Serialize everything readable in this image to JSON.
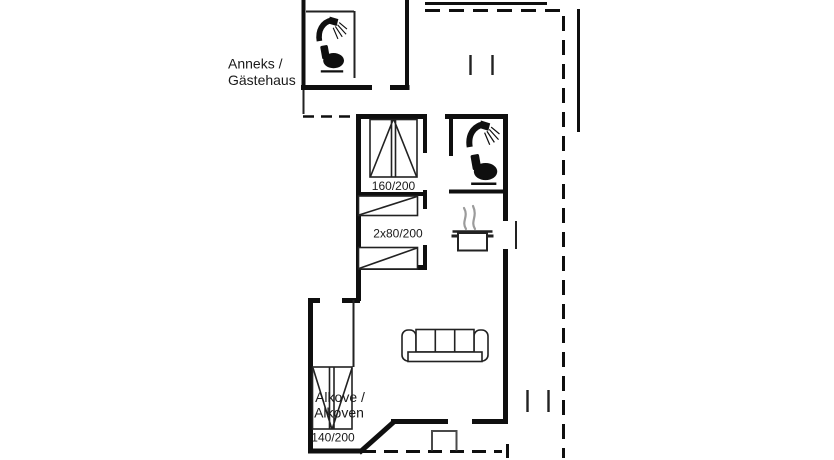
{
  "title": "Holiday house floor plan",
  "labels": {
    "anneks_line1": "Anneks /",
    "anneks_line2": "Gästehaus",
    "double_bed": "160/200",
    "bunk_beds": "2x80/200",
    "alcove_line1": "Alkove /",
    "alcove_line2": "Alkoven",
    "alcove_bed": "140/200"
  },
  "colors": {
    "background": "#ffffff",
    "wall": "#0f0f0f",
    "furniture_line": "#222222",
    "steam": "#9b9b9b",
    "step": "#4a4a4a",
    "text": "#1a1a1a"
  },
  "icons": {
    "shower": "shower-icon",
    "toilet": "toilet-icon",
    "cooking_pot": "pot-icon",
    "sofa": "sofa-icon",
    "beds": "bed-symbol"
  }
}
